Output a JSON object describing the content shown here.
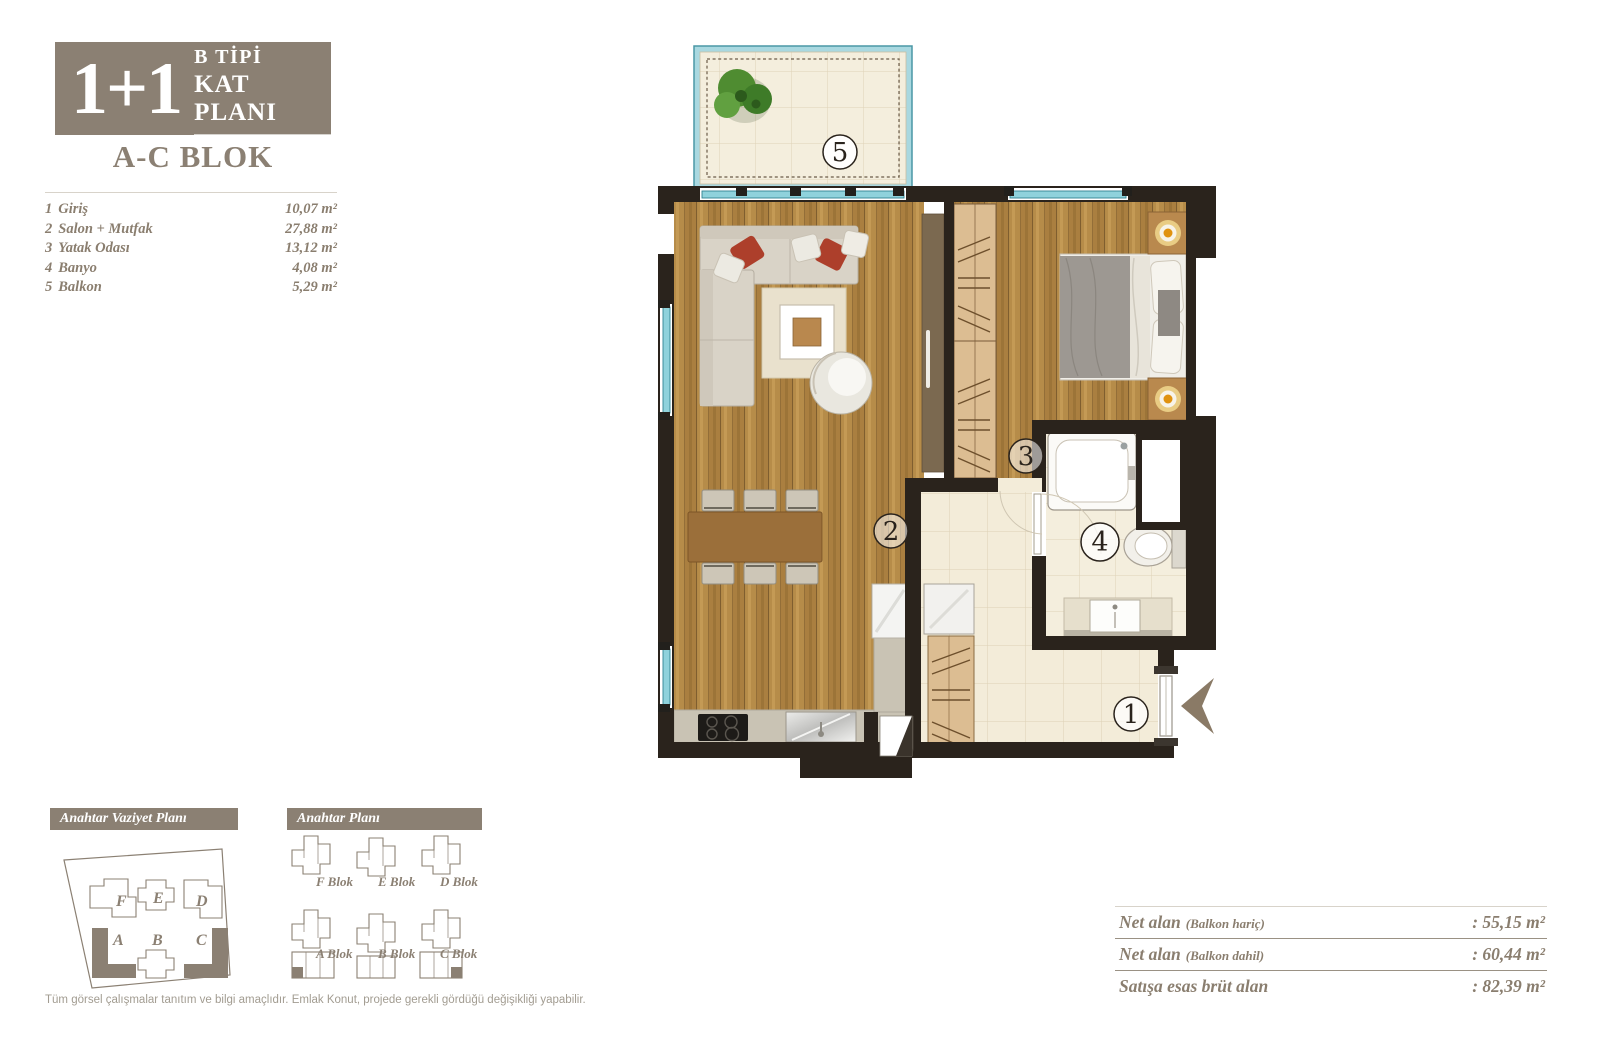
{
  "colors": {
    "brand_taupe": "#8b8073",
    "wall_dark": "#2a231c",
    "wood": "#b68c49",
    "window_teal": "#8fd2dc",
    "tile_cream": "#f3ecd9",
    "accent_red": "#ad3f2b"
  },
  "header": {
    "unit": "1+1",
    "type_line1": "B TİPİ",
    "type_line2": "KAT PLANI",
    "block": "A-C BLOK"
  },
  "room_list": [
    {
      "no": "1",
      "name": "Giriş",
      "area": "10,07 m²"
    },
    {
      "no": "2",
      "name": "Salon + Mutfak",
      "area": "27,88 m²"
    },
    {
      "no": "3",
      "name": "Yatak Odası",
      "area": "13,12 m²"
    },
    {
      "no": "4",
      "name": "Banyo",
      "area": "4,08 m²"
    },
    {
      "no": "5",
      "name": "Balkon",
      "area": "5,29 m²"
    }
  ],
  "key_site_plan": {
    "title": "Anahtar Vaziyet Planı",
    "blocks": [
      "F",
      "E",
      "D",
      "A",
      "B",
      "C"
    ],
    "highlighted_blocks": [
      "A",
      "C"
    ]
  },
  "key_plan": {
    "title": "Anahtar Planı",
    "blocks": [
      {
        "label": "F Blok"
      },
      {
        "label": "E Blok"
      },
      {
        "label": "D Blok"
      },
      {
        "label": "A Blok"
      },
      {
        "label": "B Blok"
      },
      {
        "label": "C Blok"
      }
    ]
  },
  "summary": {
    "rows": [
      {
        "label": "Net alan",
        "qualifier": "(Balkon hariç)",
        "value": ": 55,15 m²"
      },
      {
        "label": "Net alan",
        "qualifier": "(Balkon dahil)",
        "value": ": 60,44 m²"
      },
      {
        "label": "Satışa esas brüt alan",
        "qualifier": "",
        "value": ": 82,39 m²"
      }
    ]
  },
  "footer": {
    "disclaimer": "Tüm görsel çalışmalar tanıtım ve bilgi amaçlıdır. Emlak Konut, projede gerekli gördüğü değişikliği yapabilir."
  }
}
